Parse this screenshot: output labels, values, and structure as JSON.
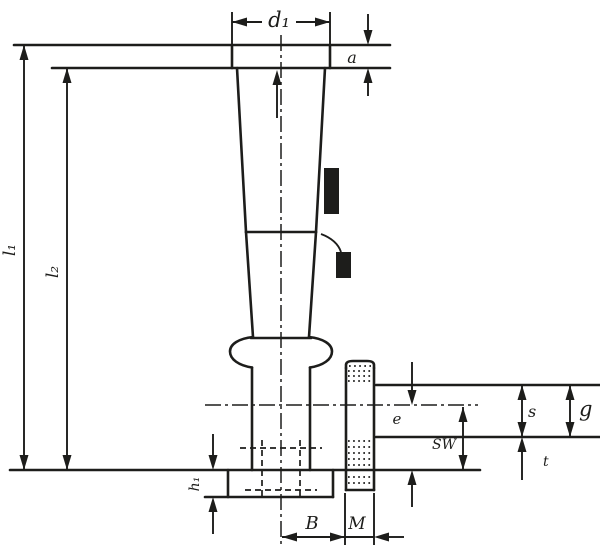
{
  "drawing": {
    "title": "handle-with-threaded-stud-dimension-drawing",
    "line_color": "#1d1d1b",
    "background_color": "#ffffff",
    "labels": {
      "top_width": "d₁",
      "cap_height": "a",
      "overall_length": "l₁",
      "body_length": "l₂",
      "stud_offset": "e",
      "across_flats": "SW",
      "step_height": "s",
      "groove_height": "g",
      "tip_height": "t",
      "base_width": "B",
      "thread": "M",
      "flange_height": "h₁"
    }
  }
}
